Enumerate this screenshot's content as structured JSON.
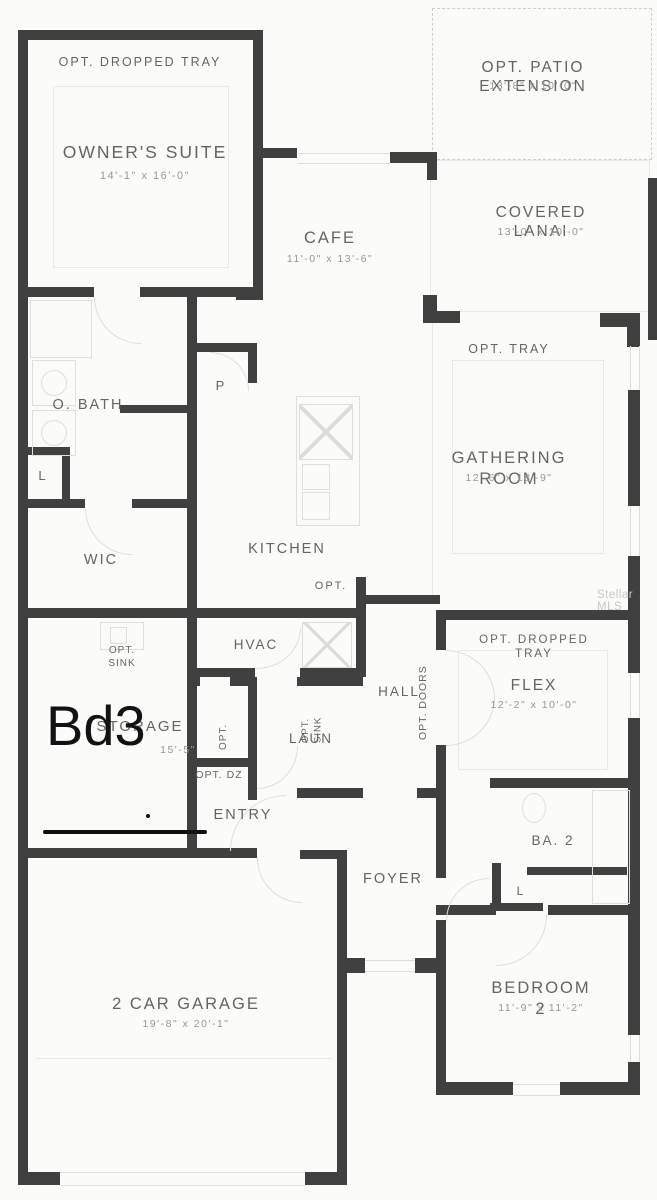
{
  "plan": {
    "watermark": "Stellar MLS",
    "handwritten_note": {
      "label": "Bd3"
    },
    "rooms": {
      "owners_suite": {
        "label": "OWNER'S SUITE",
        "dims": "14'-1\" x 16'-0\"",
        "opt": "OPT. DROPPED TRAY"
      },
      "cafe": {
        "label": "CAFE",
        "dims": "11'-0\" x 13'-6\""
      },
      "patio": {
        "label": "OPT. PATIO EXTENSION",
        "dims": "13'-8\" x 10'-0\""
      },
      "lanai": {
        "label": "COVERED LANAI",
        "dims": "13'-0\" x 10'-0\""
      },
      "gathering": {
        "label": "GATHERING ROOM",
        "dims": "12'-6\" x 18'-9\"",
        "opt": "OPT. TRAY"
      },
      "obath": {
        "label": "O. BATH"
      },
      "linen1": {
        "label": "L"
      },
      "pantry": {
        "label": "P"
      },
      "wic": {
        "label": "WIC"
      },
      "kitchen": {
        "label": "KITCHEN",
        "opt": "OPT."
      },
      "hvac": {
        "label": "HVAC"
      },
      "hall": {
        "label": "HALL",
        "opt_doors": "OPT. DOORS"
      },
      "storage": {
        "label": "STORAGE",
        "dims": "15'-5\"",
        "opt_sink": "OPT.\nSINK"
      },
      "laundry": {
        "label": "LAUN",
        "opt_sink": "OPT.\nSINK",
        "opt": "OPT.",
        "opt_dz": "OPT. DZ"
      },
      "entry": {
        "label": "ENTRY"
      },
      "foyer": {
        "label": "FOYER"
      },
      "flex": {
        "label": "FLEX",
        "dims": "12'-2\" x 10'-0\"",
        "opt": "OPT. DROPPED TRAY"
      },
      "bath2": {
        "label": "BA. 2"
      },
      "linen2": {
        "label": "L"
      },
      "bedroom2": {
        "label": "BEDROOM 2",
        "dims": "11'-9\" x 11'-2\""
      },
      "garage": {
        "label": "2 CAR GARAGE",
        "dims": "19'-8\" x 20'-1\""
      }
    },
    "colors": {
      "wall": "#404040",
      "label": "#646462",
      "dims": "#989893",
      "annotation": "#121212",
      "fixture": "#dfdfdb",
      "watermark": "#c8c8c5"
    }
  }
}
